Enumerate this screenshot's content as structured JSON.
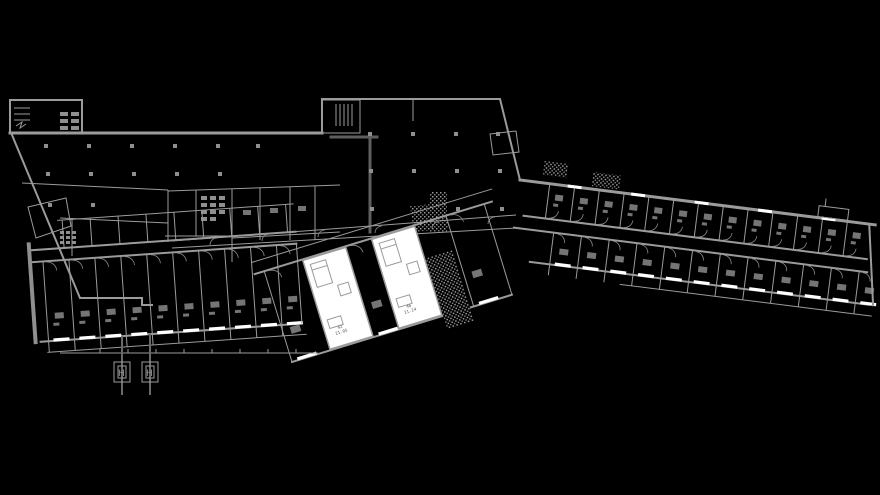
{
  "app": {
    "title": "building-floor-plan-view"
  },
  "plan": {
    "background_color": "#000000",
    "wall_color": "#9b9b9b",
    "dark_wall_color": "#5e5e5e",
    "highlight_color": "#ffffff",
    "furniture_color": "#757575",
    "rooms": {
      "highlighted": [
        {
          "number": "42",
          "area": "21.05"
        },
        {
          "number": "46",
          "area": "21.24"
        }
      ]
    },
    "markers": {
      "section_symbol": "H"
    },
    "legend": {
      "wings": [
        "left-hall-block",
        "top-center-hall",
        "bottom-left-room-wing",
        "middle-room-wing",
        "right-room-wing"
      ],
      "features": [
        "column-grid",
        "central-diagonal-corridor",
        "balcony-band",
        "window-openings",
        "stippled-ramp",
        "entrance-canopies",
        "stair-room",
        "section-markers"
      ]
    }
  }
}
